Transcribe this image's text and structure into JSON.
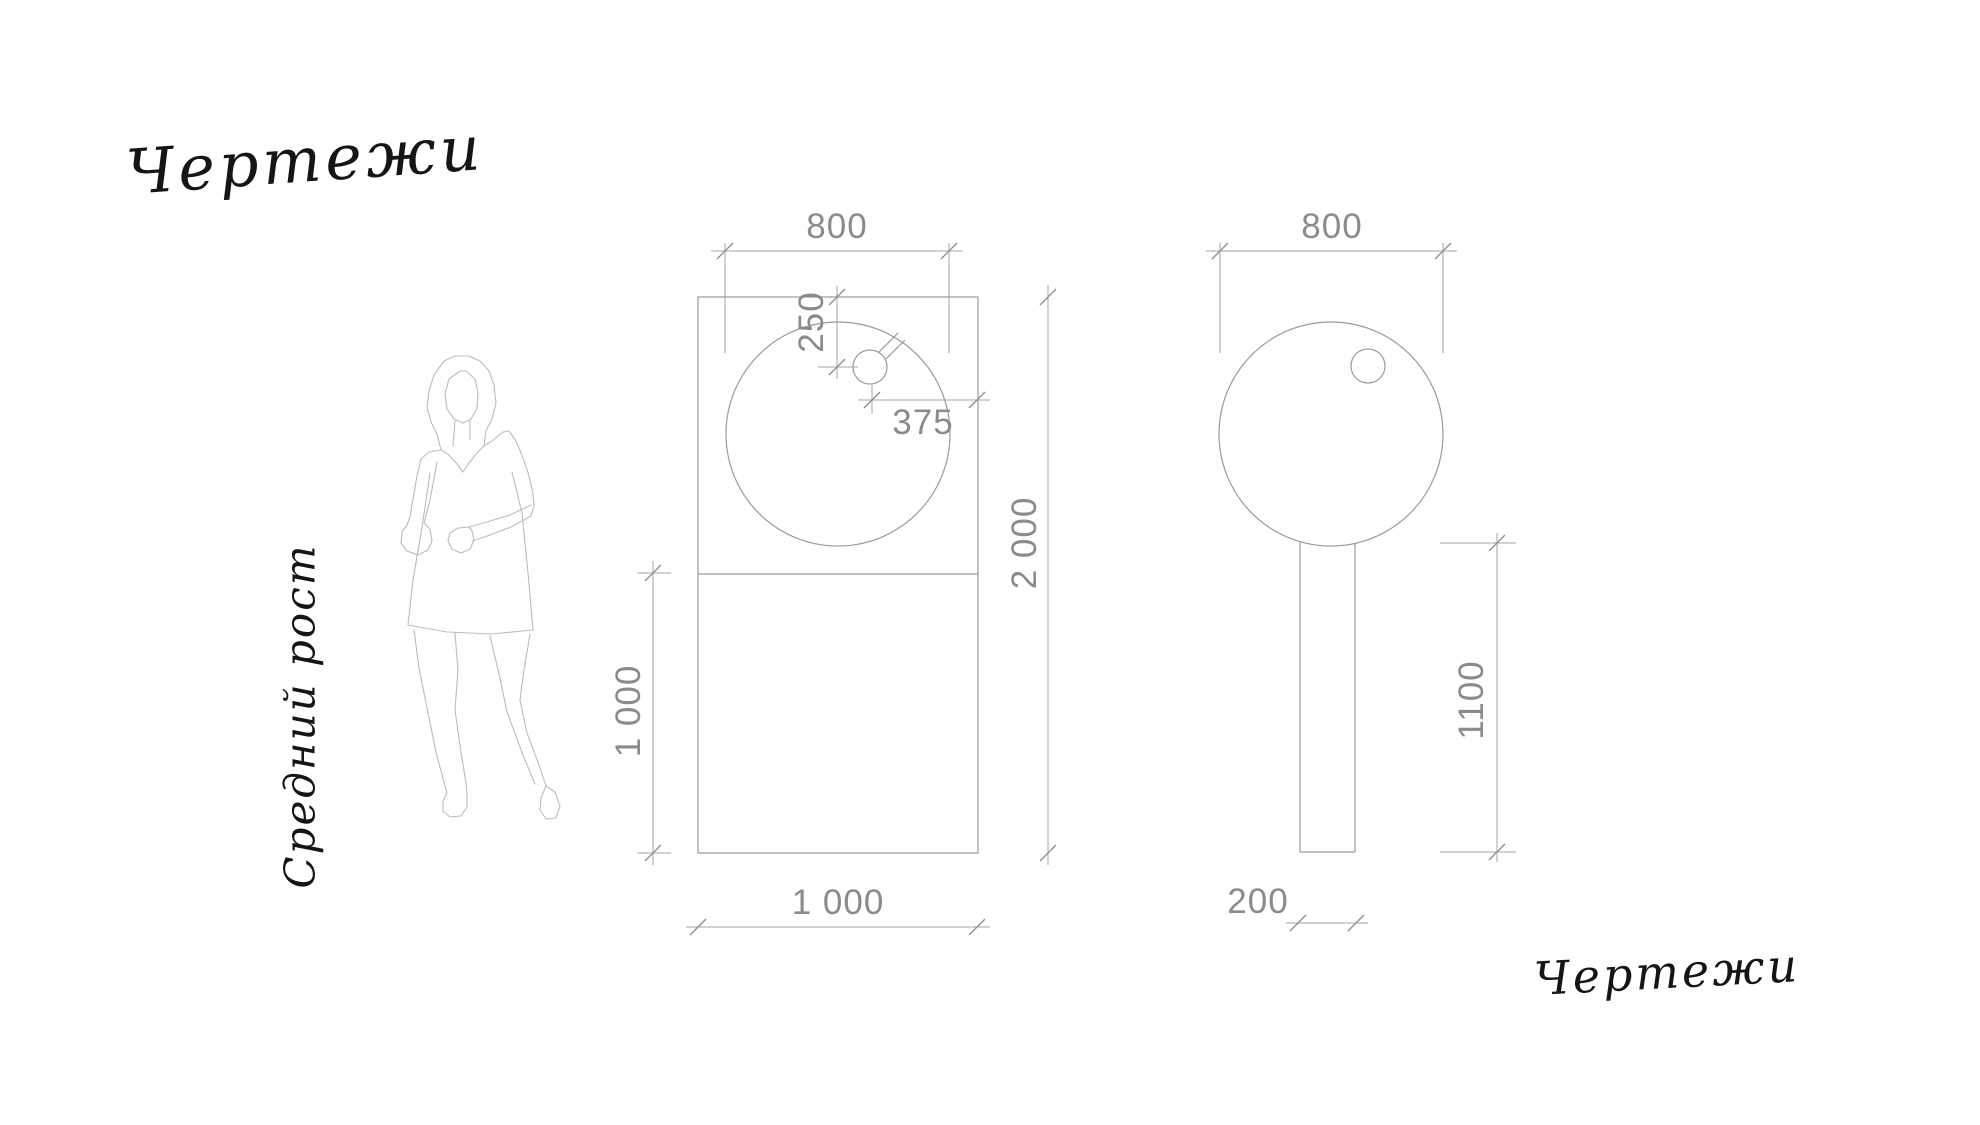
{
  "titles": {
    "top_left": "Чертежи",
    "side_vertical": "Средний рост",
    "bottom_right": "Чертежи"
  },
  "front_view": {
    "dims": {
      "circle_width": "800",
      "hole_from_top": "250",
      "hole_from_right": "375",
      "total_height": "2 000",
      "lower_height": "1 000",
      "bottom_width": "1 000"
    }
  },
  "side_view": {
    "dims": {
      "circle_width": "800",
      "post_height": "1100",
      "post_width": "200"
    }
  },
  "colors": {
    "outline_line": "#9a9a9a",
    "dimension_line": "#a6a6a6",
    "tick_mark": "#8f8f8f",
    "figure_line": "#bcbcbc",
    "dimension_text": "#8b8b8b",
    "handwriting_ink": "#151515",
    "background": "#ffffff"
  }
}
